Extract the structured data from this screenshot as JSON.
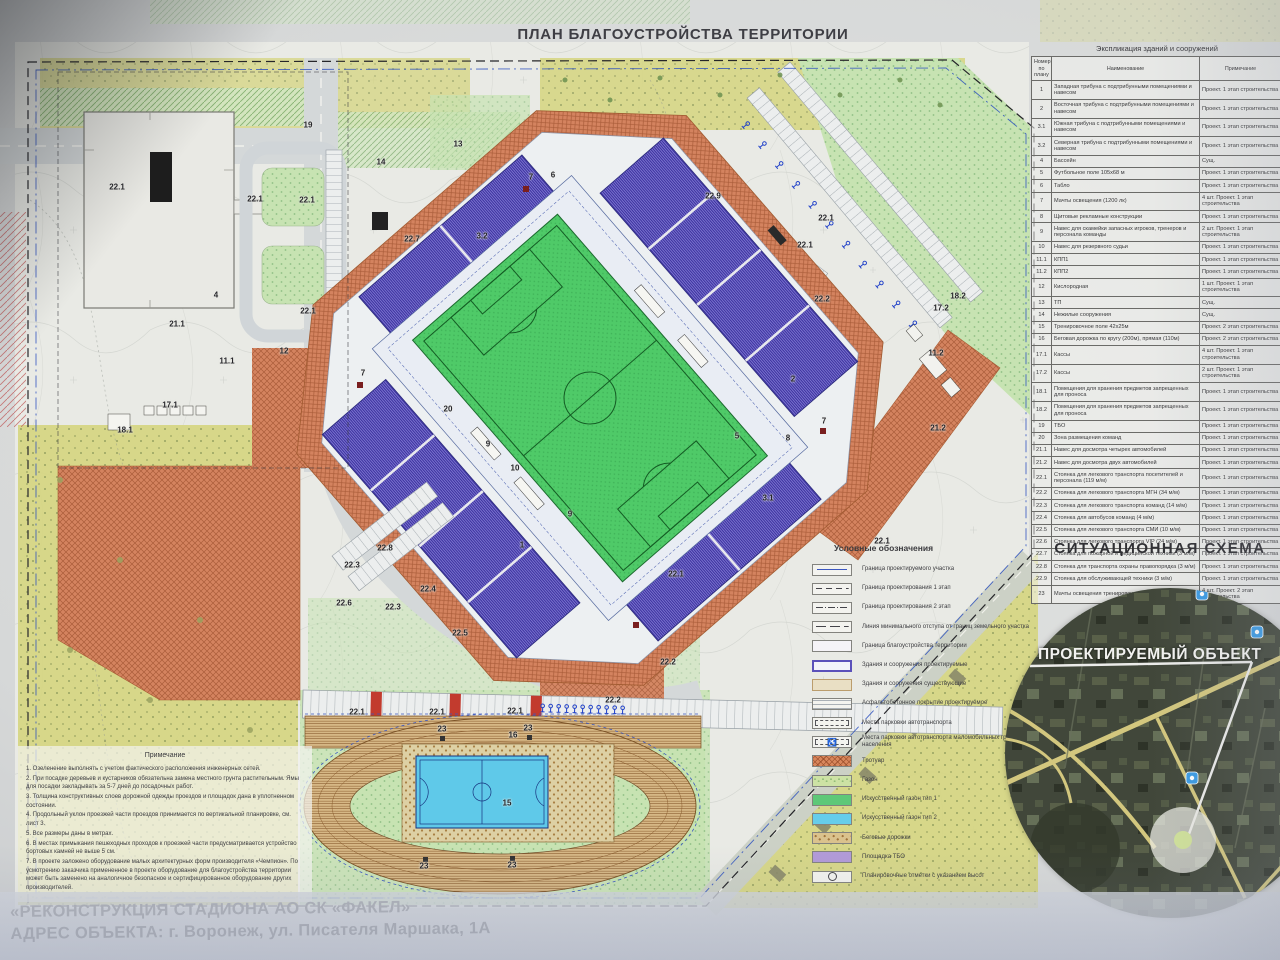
{
  "page": {
    "title": "ПЛАН БЛАГОУСТРОЙСТВА ТЕРРИТОРИИ"
  },
  "project": {
    "line1": "«РЕКОНСТРУКЦИЯ СТАДИОНА АО СК «ФАКЕЛ»",
    "line2_label": "АДРЕС ОБЪЕКТА:",
    "line2_value": " г. Воронеж, ул. Писателя Маршака, 1А"
  },
  "explication": {
    "title": "Экспликация зданий и сооружений",
    "columns": [
      "Номер по плану",
      "Наименование",
      "Примечание"
    ],
    "rows": [
      [
        "1",
        "Западная трибуна с подтрибунными помещениями и навесом",
        "Проект. 1 этап строительства"
      ],
      [
        "2",
        "Восточная трибуна с подтрибунными помещениями и навесом",
        "Проект. 1 этап строительства"
      ],
      [
        "3.1",
        "Южная трибуна с подтрибунными помещениями и навесом",
        "Проект. 1 этап строительства"
      ],
      [
        "3.2",
        "Северная трибуна с подтрибунными помещениями и навесом",
        "Проект. 1 этап строительства"
      ],
      [
        "4",
        "Бассейн",
        "Сущ."
      ],
      [
        "5",
        "Футбольное поле 105х68 м",
        "Проект. 1 этап строительства"
      ],
      [
        "6",
        "Табло",
        "Проект. 1 этап строительства"
      ],
      [
        "7",
        "Мачты освещения (1200 лк)",
        "4 шт. Проект. 1 этап строительства"
      ],
      [
        "8",
        "Щитовые рекламные конструкции",
        "Проект. 1 этап строительства"
      ],
      [
        "9",
        "Навес для скамейки запасных игроков, тренеров и персонала команды",
        "2 шт. Проект. 1 этап строительства"
      ],
      [
        "10",
        "Навес для резервного судьи",
        "Проект. 1 этап строительства"
      ],
      [
        "11.1",
        "КПП1",
        "Проект. 1 этап строительства"
      ],
      [
        "11.2",
        "КПП2",
        "Проект. 1 этап строительства"
      ],
      [
        "12",
        "Кислородная",
        "1 шт. Проект. 1 этап строительства"
      ],
      [
        "13",
        "ТП",
        "Сущ."
      ],
      [
        "14",
        "Нежилые сооружения",
        "Сущ."
      ],
      [
        "15",
        "Тренировочное поле 42х25м",
        "Проект. 2 этап строительства"
      ],
      [
        "16",
        "Беговая дорожка по кругу (200м), прямая (110м)",
        "Проект. 2 этап строительства"
      ],
      [
        "17.1",
        "Кассы",
        "4 шт. Проект. 1 этап строительства"
      ],
      [
        "17.2",
        "Кассы",
        "2 шт. Проект. 1 этап строительства"
      ],
      [
        "18.1",
        "Помещения для хранения предметов запрещенных для проноса",
        "Проект. 1 этап строительства"
      ],
      [
        "18.2",
        "Помещения для хранения предметов запрещенных для проноса",
        "Проект. 1 этап строительства"
      ],
      [
        "19",
        "ТБО",
        "Проект. 1 этап строительства"
      ],
      [
        "20",
        "Зона размещения команд",
        "Проект. 1 этап строительства"
      ],
      [
        "21.1",
        "Навес для досмотра четырех автомобилей",
        "Проект. 1 этап строительства"
      ],
      [
        "21.2",
        "Навес для досмотра двух автомобилей",
        "Проект. 1 этап строительства"
      ],
      [
        "22.1",
        "Стоянка для легкового транспорта посетителей и персонала (119 м/м)",
        "Проект. 1 этап строительства"
      ],
      [
        "22.2",
        "Стоянка для легкового транспорта МГН (34 м/м)",
        "Проект. 1 этап строительства"
      ],
      [
        "22.3",
        "Стоянка для легкового транспорта команд (14 м/м)",
        "Проект. 1 этап строительства"
      ],
      [
        "22.4",
        "Стоянка для автобусов команд (4 м/м)",
        "Проект. 1 этап строительства"
      ],
      [
        "22.5",
        "Стоянка для легкового транспорта СМИ (10 м/м)",
        "Проект. 1 этап строительства"
      ],
      [
        "22.6",
        "Стоянка для легкового транспорта VIP (24 м/м)",
        "Проект. 1 этап строительства"
      ],
      [
        "22.7",
        "Стоянка для пожарной и медицинской техники (3 м/м)",
        "Проект. 1 этап строительства"
      ],
      [
        "22.8",
        "Стоянка для транспорта охраны правопорядка (3 м/м)",
        "Проект. 1 этап строительства"
      ],
      [
        "22.9",
        "Стоянка для обслуживающей техники (3 м/м)",
        "Проект. 1 этап строительства"
      ],
      [
        "23",
        "Мачты освещения тренировочного поля",
        "4 шт. Проект. 2 этап строительства"
      ]
    ]
  },
  "legend": {
    "title": "Условные обозначения",
    "items": [
      {
        "label": "Граница проектируемого участка",
        "swatch": "sw-b1",
        "glyph": ""
      },
      {
        "label": "Граница проектирования 1 этап",
        "swatch": "sw-b2",
        "glyph": ""
      },
      {
        "label": "Граница проектирования 2 этап",
        "swatch": "sw-b3",
        "glyph": ""
      },
      {
        "label": "Линия минимального отступа от границ земельного участка",
        "swatch": "sw-b4",
        "glyph": ""
      },
      {
        "label": "Граница благоустройства территории",
        "swatch": "sw-b5",
        "glyph": ""
      },
      {
        "label": "Здания и сооружения проектируемые",
        "swatch": "sw-new",
        "glyph": ""
      },
      {
        "label": "Здания и сооружения существующие",
        "swatch": "sw-exist",
        "glyph": ""
      },
      {
        "label": "Асфальтобетонное покрытие проектируемое",
        "swatch": "sw-asph",
        "glyph": ""
      },
      {
        "label": "Места парковки автотранспорта",
        "swatch": "sw-park",
        "glyph": ""
      },
      {
        "label": "Места парковки автотранспорта маломобильных групп населения",
        "swatch": "sw-mgn",
        "glyph": "♿"
      },
      {
        "label": "Тротуар",
        "swatch": "sw-trot",
        "glyph": ""
      },
      {
        "label": "Газон",
        "swatch": "sw-gazon",
        "glyph": ""
      },
      {
        "label": "Искусственный газон тип 1",
        "swatch": "sw-g1",
        "glyph": ""
      },
      {
        "label": "Искусственный газон тип 2",
        "swatch": "sw-g2",
        "glyph": ""
      },
      {
        "label": "Беговые дорожки",
        "swatch": "sw-track",
        "glyph": ""
      },
      {
        "label": "Площадка ТБО",
        "swatch": "sw-tbo",
        "glyph": ""
      },
      {
        "label": "Планировочные отметки с указанием высот",
        "swatch": "sw-mark",
        "glyph": ""
      }
    ]
  },
  "situational": {
    "title": "СИТУАЦИОННАЯ СХЕМА",
    "object_label": "ПРОЕКТИРУЕМЫЙ ОБЪЕКТ"
  },
  "notes": {
    "title": "Примечание",
    "items": [
      "1. Озеленение выполнять с учетом фактического расположения инженерных сетей.",
      "2. При посадке деревьев и кустарников обязательна замена местного грунта растительным. Ямы для посадки закладывать за 5-7 дней до посадочных работ.",
      "3. Толщина конструктивных слоев дорожной одежды проездов и площадок дана в уплотненном состоянии.",
      "4. Продольный уклон проезжей части проездов принимается по вертикальной планировке, см. лист 3.",
      "5. Все размеры даны в метрах.",
      "6. В местах примыкания пешеходных проходов к проезжей части предусматривается устройство бортовых камней не выше 5 см.",
      "7. В проекте заложено оборудование малых архитектурных форм производителя «Чемпион». По усмотрению заказчика примененное в проекте оборудование для благоустройства территории может быть заменено на аналогичное безопасное и сертифицированное оборудование других производителей."
    ]
  },
  "plan_labels": [
    {
      "t": "19",
      "x": 308,
      "y": 125
    },
    {
      "t": "14",
      "x": 381,
      "y": 162
    },
    {
      "t": "13",
      "x": 458,
      "y": 144
    },
    {
      "t": "22.1",
      "x": 117,
      "y": 187
    },
    {
      "t": "22.1",
      "x": 255,
      "y": 199
    },
    {
      "t": "22.1",
      "x": 307,
      "y": 200
    },
    {
      "t": "22.1",
      "x": 308,
      "y": 311
    },
    {
      "t": "21.1",
      "x": 177,
      "y": 324
    },
    {
      "t": "11.1",
      "x": 227,
      "y": 361
    },
    {
      "t": "12",
      "x": 284,
      "y": 351
    },
    {
      "t": "17.1",
      "x": 170,
      "y": 405
    },
    {
      "t": "18.1",
      "x": 125,
      "y": 430
    },
    {
      "t": "4",
      "x": 216,
      "y": 295
    },
    {
      "t": "22.7",
      "x": 412,
      "y": 239
    },
    {
      "t": "3.2",
      "x": 482,
      "y": 236
    },
    {
      "t": "7",
      "x": 531,
      "y": 177
    },
    {
      "t": "6",
      "x": 553,
      "y": 175
    },
    {
      "t": "22.9",
      "x": 713,
      "y": 196
    },
    {
      "t": "22.1",
      "x": 826,
      "y": 218
    },
    {
      "t": "22.1",
      "x": 805,
      "y": 245
    },
    {
      "t": "22.2",
      "x": 822,
      "y": 299
    },
    {
      "t": "18.2",
      "x": 958,
      "y": 296
    },
    {
      "t": "17.2",
      "x": 941,
      "y": 308
    },
    {
      "t": "11.2",
      "x": 936,
      "y": 353
    },
    {
      "t": "21.2",
      "x": 938,
      "y": 428
    },
    {
      "t": "2",
      "x": 793,
      "y": 379
    },
    {
      "t": "7",
      "x": 363,
      "y": 373
    },
    {
      "t": "20",
      "x": 448,
      "y": 409
    },
    {
      "t": "9",
      "x": 488,
      "y": 444
    },
    {
      "t": "10",
      "x": 515,
      "y": 468
    },
    {
      "t": "9",
      "x": 570,
      "y": 514
    },
    {
      "t": "5",
      "x": 737,
      "y": 436
    },
    {
      "t": "8",
      "x": 788,
      "y": 438
    },
    {
      "t": "3.1",
      "x": 768,
      "y": 498
    },
    {
      "t": "7",
      "x": 824,
      "y": 421
    },
    {
      "t": "1",
      "x": 522,
      "y": 545
    },
    {
      "t": "22.8",
      "x": 385,
      "y": 548
    },
    {
      "t": "22.3",
      "x": 352,
      "y": 565
    },
    {
      "t": "22.6",
      "x": 344,
      "y": 603
    },
    {
      "t": "22.3",
      "x": 393,
      "y": 607
    },
    {
      "t": "22.4",
      "x": 428,
      "y": 589
    },
    {
      "t": "22.5",
      "x": 460,
      "y": 633
    },
    {
      "t": "22.1",
      "x": 676,
      "y": 574
    },
    {
      "t": "22.2",
      "x": 668,
      "y": 662
    },
    {
      "t": "22.1",
      "x": 882,
      "y": 541
    },
    {
      "t": "22.1",
      "x": 357,
      "y": 712
    },
    {
      "t": "22.1",
      "x": 437,
      "y": 712
    },
    {
      "t": "22.1",
      "x": 515,
      "y": 711
    },
    {
      "t": "22.2",
      "x": 613,
      "y": 700
    },
    {
      "t": "23",
      "x": 442,
      "y": 729
    },
    {
      "t": "16",
      "x": 513,
      "y": 735
    },
    {
      "t": "23",
      "x": 528,
      "y": 728
    },
    {
      "t": "15",
      "x": 507,
      "y": 803
    },
    {
      "t": "23",
      "x": 424,
      "y": 866
    },
    {
      "t": "23",
      "x": 512,
      "y": 865
    }
  ],
  "colors": {
    "stand_purple": "#6a61c4",
    "pitch_green": "#4fca68",
    "court_blue": "#5fc9e9",
    "walkway_orange": "#d4835f",
    "gazon_green": "#c7e3b2",
    "vegetation_yellow": "#d6d87e",
    "track_tan": "#d6b785",
    "tbo_purple": "#b29bd8",
    "boundary_blue": "#3b57c0",
    "pin_blue": "#3b9be4"
  }
}
